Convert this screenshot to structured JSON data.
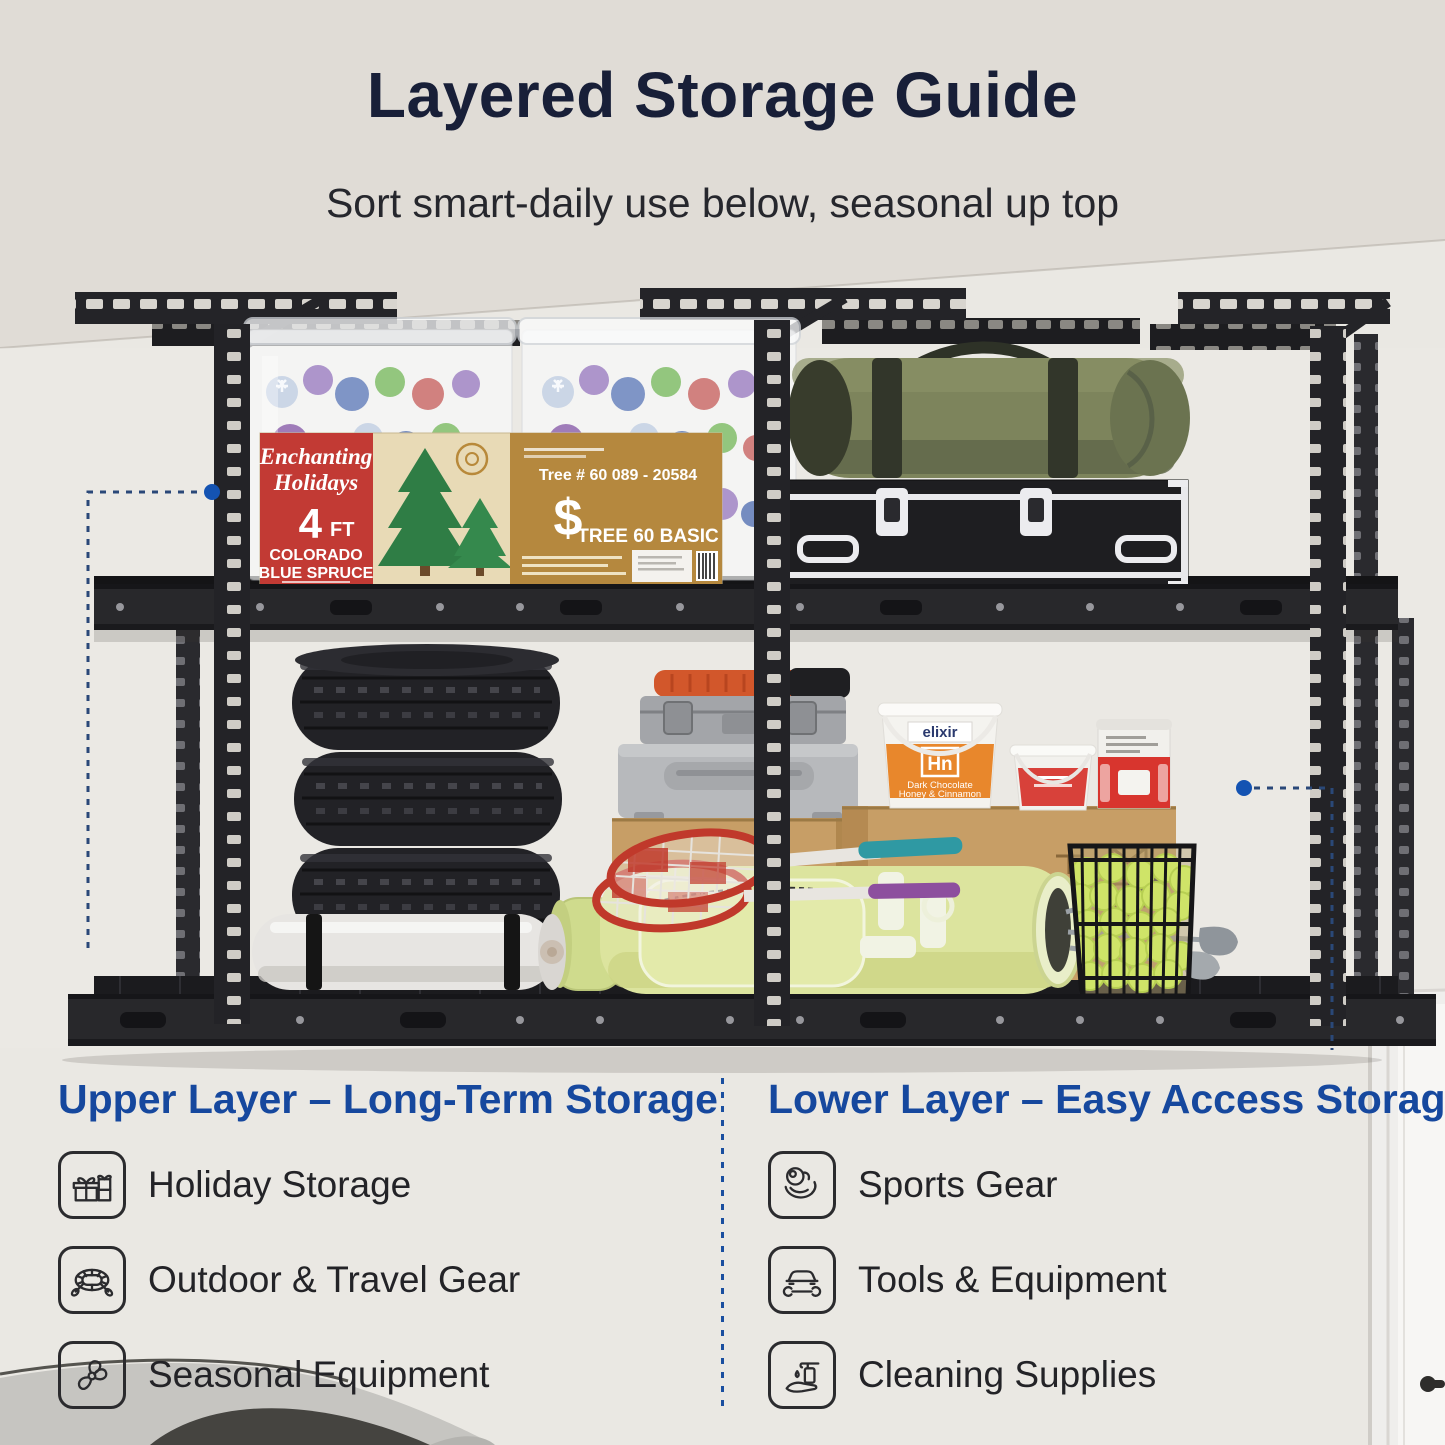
{
  "title": "Layered Storage Guide",
  "subtitle": "Sort smart-daily use below, seasonal up top",
  "sections": {
    "upper": {
      "header": "Upper Layer – Long-Term Storage",
      "items": [
        {
          "icon": "gift-icon",
          "label": "Holiday Storage"
        },
        {
          "icon": "raft-icon",
          "label": "Outdoor & Travel Gear"
        },
        {
          "icon": "fan-icon",
          "label": "Seasonal Equipment"
        }
      ]
    },
    "lower": {
      "header": "Lower Layer – Easy Access Storage",
      "items": [
        {
          "icon": "sports-icon",
          "label": "Sports Gear"
        },
        {
          "icon": "car-wrench-icon",
          "label": "Tools & Equipment"
        },
        {
          "icon": "cleaning-icon",
          "label": "Cleaning Supplies"
        }
      ]
    }
  },
  "photo_text": {
    "tree_box": {
      "brand_top": "Enchanting",
      "brand_bottom": "Holidays",
      "size_number": "4",
      "size_unit": "FT",
      "variety_line1": "COLORADO",
      "variety_line2": "BLUE SPRUCE",
      "tree_number": "Tree # 60 089 - 20584",
      "dollar_sign": "$",
      "model_name": "TREE 60 BASIC"
    },
    "bucket": {
      "brand": "elixir",
      "code": "Hn",
      "flavor_line1": "Dark Chocolate",
      "flavor_line2": "Honey & Cinnamon"
    }
  },
  "colors": {
    "accent_blue": "#16489e",
    "title_navy": "#181f38",
    "body_text": "#232327",
    "callout_blue": "#1453b2",
    "rack_black": "#232327"
  }
}
